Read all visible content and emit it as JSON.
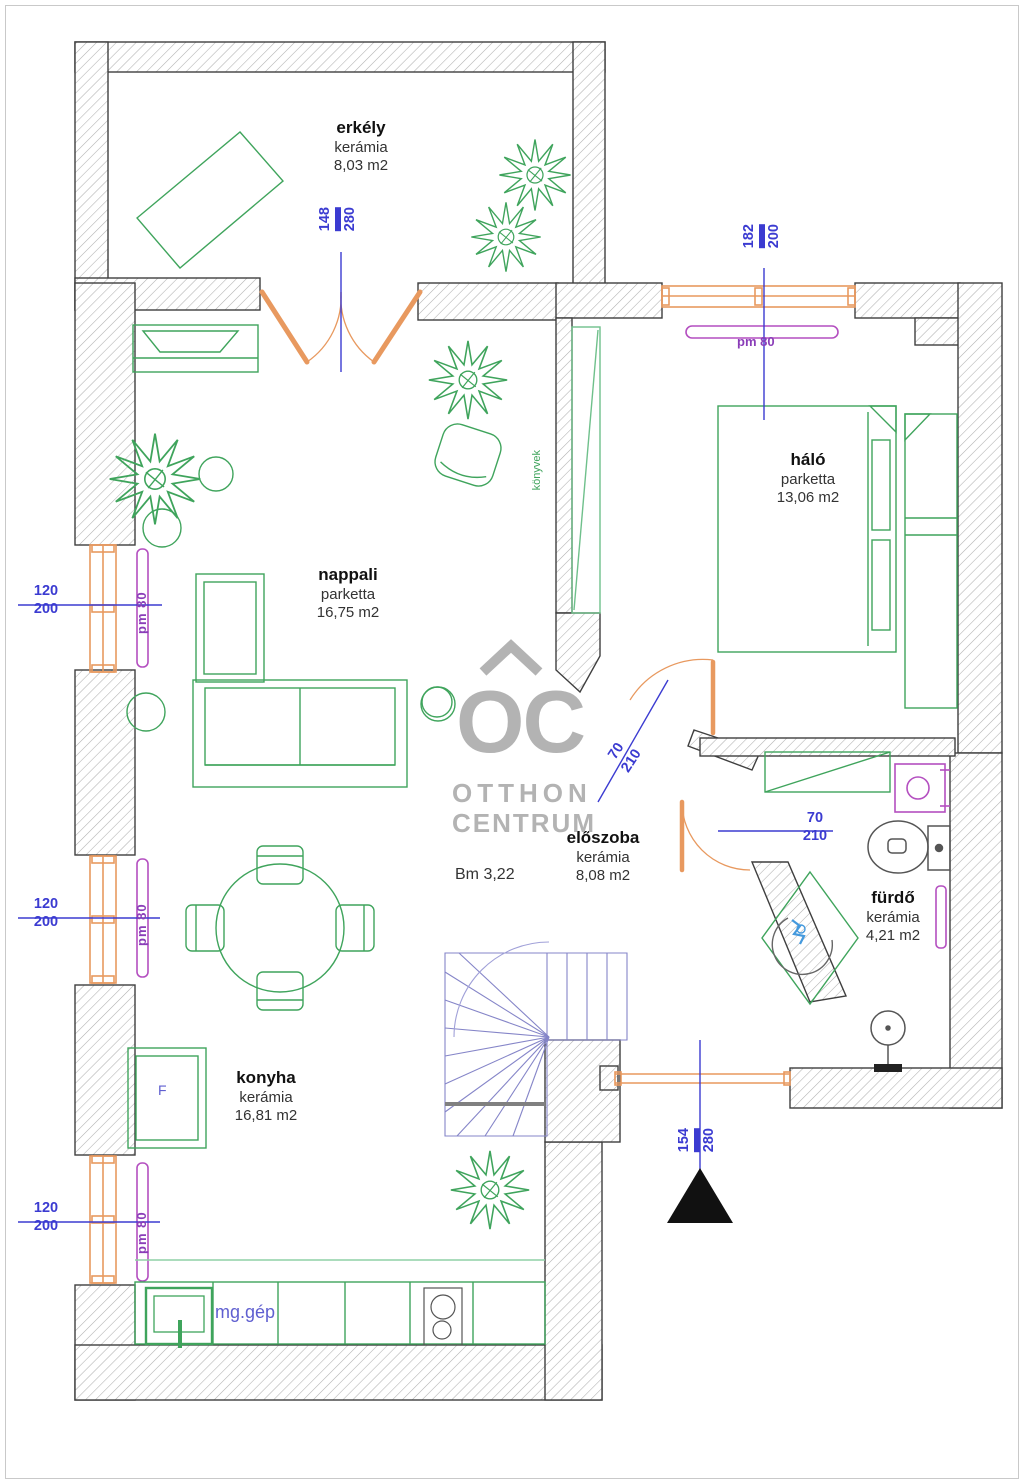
{
  "watermark": {
    "logo": "OC",
    "line1": "OTTHON",
    "line2": "CENTRUM"
  },
  "rooms": [
    {
      "key": "erkely",
      "name": "erkély",
      "material": "kerámia",
      "area": "8,03 m2"
    },
    {
      "key": "halo",
      "name": "háló",
      "material": "parketta",
      "area": "13,06 m2"
    },
    {
      "key": "nappali",
      "name": "nappali",
      "material": "parketta",
      "area": "16,75 m2"
    },
    {
      "key": "eloszoba",
      "name": "előszoba",
      "material": "kerámia",
      "area": "8,08 m2"
    },
    {
      "key": "furdo",
      "name": "fürdő",
      "material": "kerámia",
      "area": "4,21 m2"
    },
    {
      "key": "konyha",
      "name": "konyha",
      "material": "kerámia",
      "area": "16,81 m2"
    }
  ],
  "annotations": {
    "beam_height": "Bm 3,22",
    "dishwasher": "mg.gép",
    "fridge": "F",
    "books": "könyvek",
    "radiator_label": "pm 80"
  },
  "dimensions": {
    "balcony_door": {
      "width": "148",
      "height": "280"
    },
    "bedroom_window": {
      "width": "182",
      "height": "200"
    },
    "left_window_1": {
      "width": "120",
      "height": "200"
    },
    "left_window_2": {
      "width": "120",
      "height": "200"
    },
    "left_window_3": {
      "width": "120",
      "height": "200"
    },
    "bedroom_door": {
      "width": "70",
      "height": "210"
    },
    "bathroom_door": {
      "width": "70",
      "height": "210"
    },
    "south_window": {
      "width": "154",
      "height": "280"
    }
  },
  "colors": {
    "wall_outline": "#3f3f3f",
    "hatch": "#b0b0b0",
    "window_orange": "#e8995f",
    "furniture_green": "#3fa45c",
    "radiator_magenta": "#b44fc0",
    "dimension_blue": "#3b3bd1",
    "stairs_blue": "#8585c8",
    "watermark_gray": "#b3b3b3",
    "north_arrow_black": "#111111"
  }
}
